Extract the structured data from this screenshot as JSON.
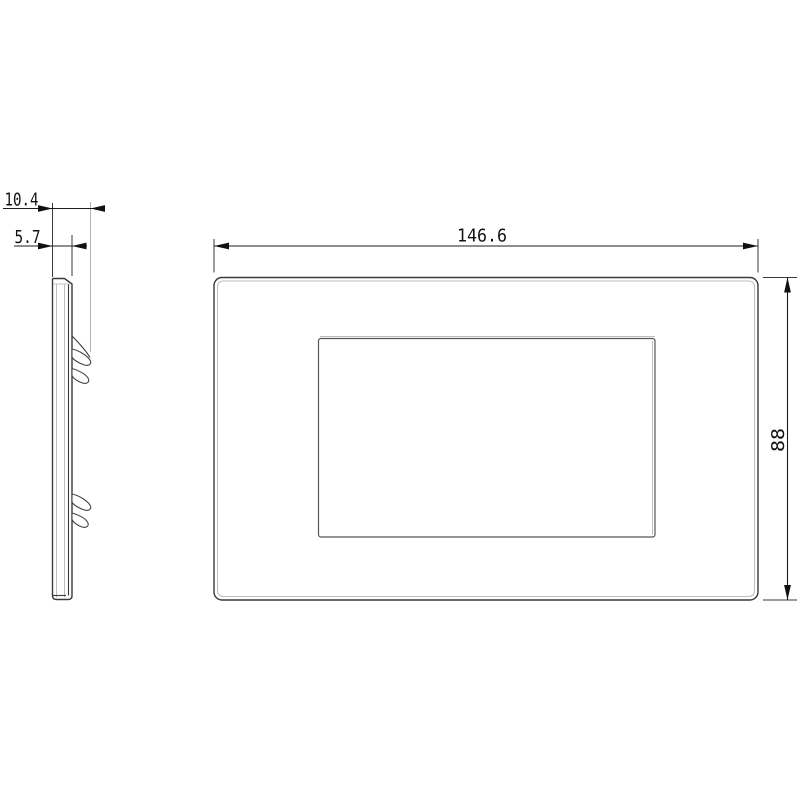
{
  "drawing": {
    "type": "technical-dimension-drawing",
    "views": {
      "side_view": "plate cross-section with mounting clips",
      "front_view": "rectangular cover plate with central rectangular opening"
    },
    "dimensions": {
      "total_depth": "10.4",
      "plate_depth": "5.7",
      "front_width": "146.6",
      "front_height": "88"
    },
    "colors": {
      "background": "#ffffff",
      "object_line": "#3a3a3a",
      "hidden_edge_line": "#bdbdbd",
      "dimension_line": "#1c1c1c",
      "dimension_text": "#111111"
    }
  }
}
